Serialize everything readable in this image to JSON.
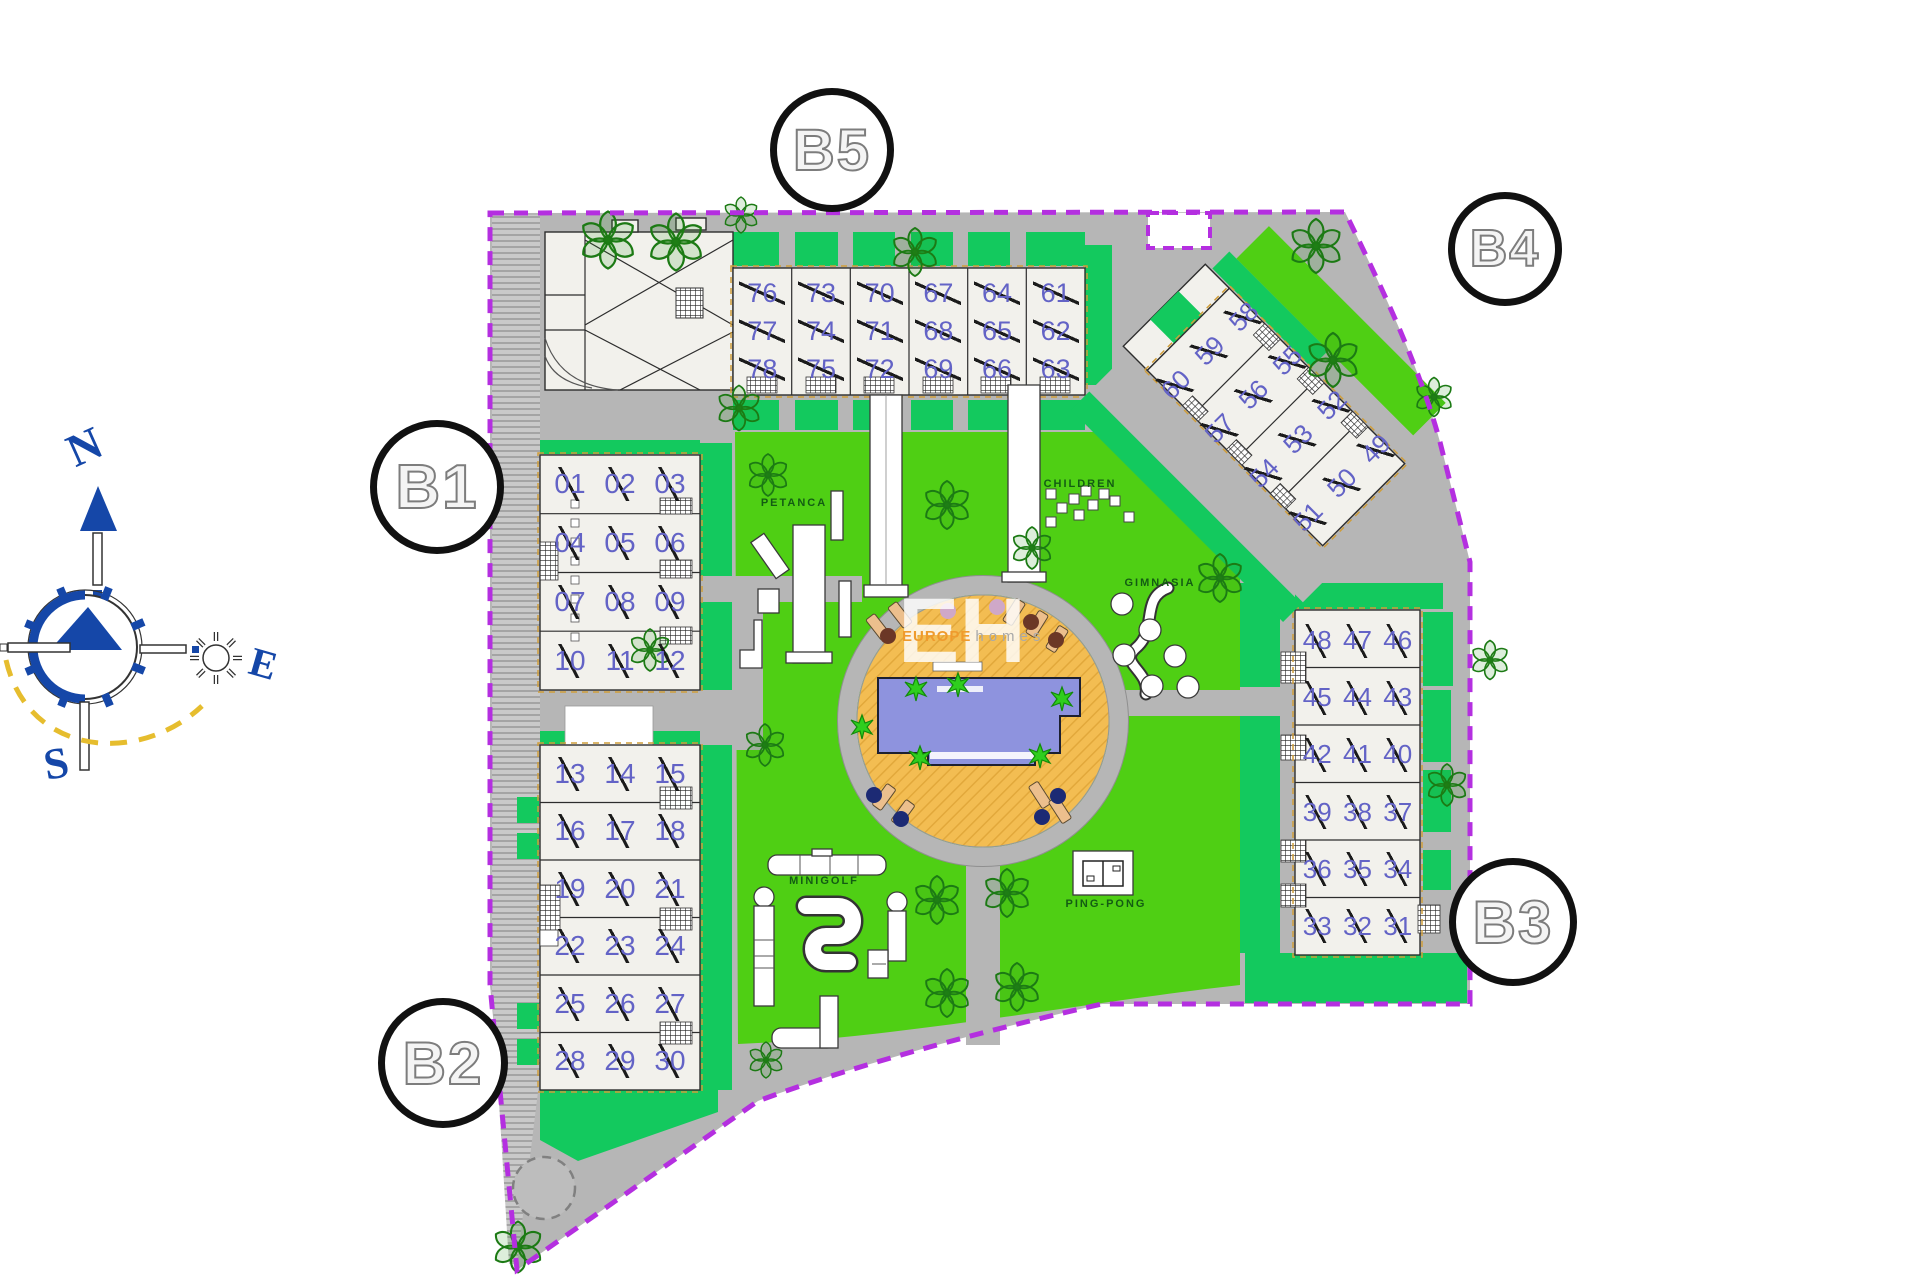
{
  "compass": {
    "north": "N",
    "east": "E",
    "south": "S"
  },
  "watermark": {
    "initials": "EH",
    "brand": "EUROPE",
    "brand_suffix": "homes"
  },
  "blocks": {
    "b1": {
      "label": "B1",
      "rows": [
        [
          "01",
          "02",
          "03"
        ],
        [
          "04",
          "05",
          "06"
        ],
        [
          "07",
          "08",
          "09"
        ],
        [
          "10",
          "11",
          "12"
        ]
      ]
    },
    "b2": {
      "label": "B2",
      "rows": [
        [
          "13",
          "14",
          "15"
        ],
        [
          "16",
          "17",
          "18"
        ],
        [
          "19",
          "20",
          "21"
        ],
        [
          "22",
          "23",
          "24"
        ],
        [
          "25",
          "26",
          "27"
        ],
        [
          "28",
          "29",
          "30"
        ]
      ]
    },
    "b3": {
      "label": "B3",
      "rows": [
        [
          "48",
          "47",
          "46"
        ],
        [
          "45",
          "44",
          "43"
        ],
        [
          "42",
          "41",
          "40"
        ],
        [
          "39",
          "38",
          "37"
        ],
        [
          "36",
          "35",
          "34"
        ],
        [
          "33",
          "32",
          "31"
        ]
      ]
    },
    "b4": {
      "label": "B4",
      "rows": [
        [
          "60",
          "59",
          "58"
        ],
        [
          "57",
          "56",
          "55"
        ],
        [
          "54",
          "53",
          "52"
        ],
        [
          "51",
          "50",
          "49"
        ]
      ]
    },
    "b5": {
      "label": "B5",
      "columns": [
        [
          "76",
          "77",
          "78"
        ],
        [
          "73",
          "74",
          "75"
        ],
        [
          "70",
          "71",
          "72"
        ],
        [
          "67",
          "68",
          "69"
        ],
        [
          "64",
          "65",
          "66"
        ],
        [
          "61",
          "62",
          "63"
        ]
      ]
    }
  },
  "amenities": {
    "petanca": {
      "label": "PETANCA"
    },
    "children": {
      "label": "CHILDREN"
    },
    "gimnasia": {
      "label": "GIMNASIA"
    },
    "minigolf": {
      "label": "MINIGOLF"
    },
    "pingpong": {
      "label": "PING-PONG"
    }
  },
  "colors": {
    "boundary": "#b42fe0",
    "road": "#b6b6b6",
    "lawn": "#4fcf14",
    "emerald": "#13c95e",
    "building": "#f2f1ec",
    "unit": "#6363c6",
    "deck": "#f3bd52",
    "pool": "#8e93de",
    "tree": "#1c7a14",
    "compass": "#1547a8",
    "sunArc": "#e6bd2e",
    "labelGreen": "#135c13"
  }
}
